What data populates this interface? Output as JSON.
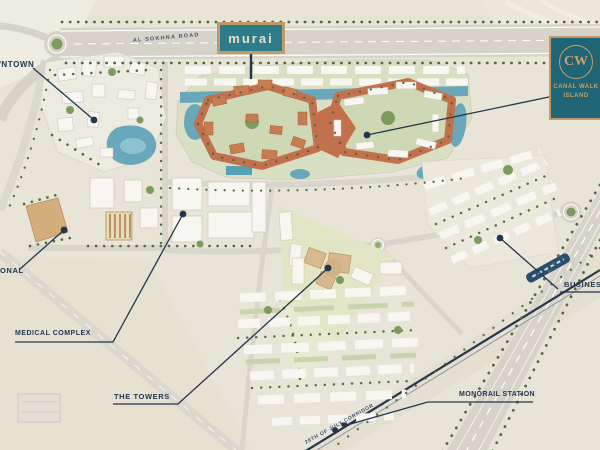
{
  "map": {
    "signs": {
      "murai": {
        "text": "murai"
      },
      "canal_walk_island": {
        "monogram": "CW",
        "name_line1": "CANAL WALK",
        "name_line2": "ISLAND"
      }
    },
    "road_labels": {
      "highway": "AL SOKHNA ROAD",
      "corridor": "26TH OF JULY CORRIDOR"
    },
    "callouts": [
      {
        "id": "downtown",
        "label": "DOWNTOWN"
      },
      {
        "id": "educational",
        "label": "ONAL"
      },
      {
        "id": "medical-complex",
        "label": "MEDICAL COMPLEX"
      },
      {
        "id": "the-towers",
        "label": "THE TOWERS"
      },
      {
        "id": "monorail-station",
        "label": "MONORAIL STATION"
      },
      {
        "id": "business",
        "label": "BUSINESS"
      }
    ],
    "colors": {
      "sand": "#e9e4d8",
      "road_gray": "#d7d3c9",
      "terracotta": "#c3714d",
      "water_teal": "#68a8ba",
      "sign_teal": "#2e7b8a",
      "logo_teal": "#1f6576",
      "brand_tan": "#c09a6a",
      "callout_navy": "#22374e",
      "tree_green": "#4f6b3f"
    }
  }
}
